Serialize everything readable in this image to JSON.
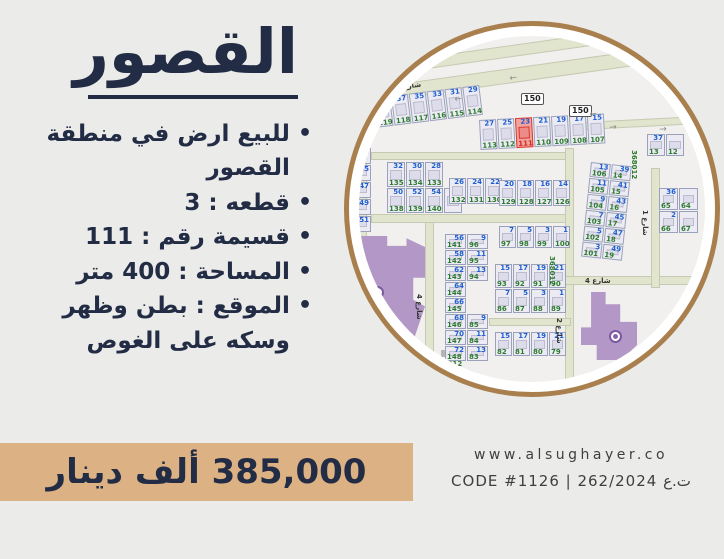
{
  "left_panel": {
    "title": "القصور",
    "bullets": [
      "للبيع ارض في منطقة القصور",
      "قطعه : 3",
      "قسيمة رقم : 111",
      "المساحة : 400 متر",
      "الموقع : بطن وظهر وسكه على الغوص"
    ]
  },
  "price_banner": {
    "text": "385,000 ألف دينار",
    "bg": "#dcb183"
  },
  "footer": {
    "website": "www.alsughayer.co",
    "code_line": "CODE #1126  |  262/2024 ت.ع"
  },
  "colors": {
    "accent_navy": "#232c45",
    "banner_tan": "#dcb183",
    "circle_border": "#a87f4d",
    "highlight_red": "#d8392d",
    "parcel_blue": "#1d5fd2",
    "parcel_green": "#2c7a2f",
    "building_purple": "#b297c7",
    "road_green": "#e2e5cd"
  },
  "map": {
    "roads": [
      {
        "x": -40,
        "y": -58,
        "w": 450,
        "h": 78,
        "rot": -8,
        "color": "#fbfbf8",
        "border": "none"
      },
      {
        "x": -25,
        "y": 34,
        "w": 400,
        "h": 12,
        "rot": -8
      },
      {
        "x": -25,
        "y": 57,
        "w": 420,
        "h": 15,
        "rot": -8
      },
      {
        "x": 225,
        "y": 86,
        "w": 130,
        "h": 8,
        "rot": -3
      },
      {
        "x": 12,
        "y": 116,
        "w": 200,
        "h": 8
      },
      {
        "x": 0,
        "y": 116,
        "w": 8,
        "h": 112
      },
      {
        "x": 12,
        "y": 178,
        "w": 200,
        "h": 9
      },
      {
        "x": 66,
        "y": 186,
        "w": 9,
        "h": 160
      },
      {
        "x": 206,
        "y": 112,
        "w": 9,
        "h": 234
      },
      {
        "x": 206,
        "y": 240,
        "w": 140,
        "h": 9
      },
      {
        "x": 292,
        "y": 132,
        "w": 9,
        "h": 120
      },
      {
        "x": 130,
        "y": 282,
        "w": 82,
        "h": 8
      }
    ],
    "street_labels": [
      {
        "text": "شارع مكراد",
        "x": 8,
        "y": 26,
        "rot": -8
      },
      {
        "text": "شارع مكراد المكر",
        "x": 2,
        "y": 53,
        "rot": -8
      },
      {
        "text": "شارع 4",
        "x": 0,
        "y": 128,
        "rot": 90
      },
      {
        "text": "شارع 4",
        "x": 64,
        "y": 258,
        "rot": 90
      },
      {
        "text": "شارع 2",
        "x": 204,
        "y": 282,
        "rot": 90
      },
      {
        "text": "شارع 1",
        "x": 290,
        "y": 174,
        "rot": 90
      },
      {
        "text": "شارع 4",
        "x": 226,
        "y": 241,
        "rot": 0
      }
    ],
    "route_badges": [
      {
        "text": "150",
        "x": 162,
        "y": 57
      },
      {
        "text": "150",
        "x": 210,
        "y": 69
      }
    ],
    "plot_codes": [
      {
        "text": "368012",
        "x": 197,
        "y": 220,
        "rot": 90
      },
      {
        "text": "368012",
        "x": 279,
        "y": 114,
        "rot": 90
      },
      {
        "text": "368012",
        "x": 74,
        "y": 324,
        "rot": 0
      }
    ],
    "arrows": [
      {
        "glyph": "←",
        "x": 55,
        "y": 28,
        "rot": -8
      },
      {
        "glyph": "←",
        "x": 150,
        "y": 39,
        "rot": -8
      },
      {
        "glyph": "←",
        "x": 95,
        "y": 60,
        "rot": -8
      },
      {
        "glyph": "←",
        "x": 230,
        "y": 75,
        "rot": -8
      },
      {
        "glyph": "→",
        "x": 250,
        "y": 88,
        "rot": -3
      },
      {
        "glyph": "→",
        "x": 300,
        "y": 90,
        "rot": -3
      }
    ],
    "blocks": [
      {
        "x": 14,
        "y": 62,
        "rot": -7,
        "cw": 17,
        "ch": 30,
        "rows": [
          [
            {
              "b": "39",
              "g": "119"
            },
            {
              "b": "37",
              "g": "118"
            },
            {
              "b": "35",
              "g": "117"
            },
            {
              "b": "33",
              "g": "116"
            },
            {
              "b": "31",
              "g": "115"
            },
            {
              "b": "29",
              "g": "114"
            }
          ]
        ]
      },
      {
        "x": 120,
        "y": 84,
        "rot": -3,
        "cw": 17,
        "ch": 30,
        "rows": [
          [
            {
              "b": "27",
              "g": "113"
            },
            {
              "b": "25",
              "g": "112"
            },
            {
              "b": "23",
              "g": "111",
              "red": true
            },
            {
              "b": "21",
              "g": "110"
            },
            {
              "b": "19",
              "g": "109"
            },
            {
              "b": "17",
              "g": "108"
            },
            {
              "b": "15",
              "g": "107"
            }
          ]
        ]
      },
      {
        "x": 288,
        "y": 98,
        "rot": 0,
        "cw": 18,
        "ch": 22,
        "rows": [
          [
            {
              "b": "37",
              "g": "13"
            },
            {
              "b": "",
              "g": "12"
            }
          ]
        ]
      },
      {
        "x": -10,
        "y": 112,
        "rot": 0,
        "cw": 22,
        "ch": 16,
        "rows": [
          [
            {
              "b": "43",
              "g": ""
            }
          ],
          [
            {
              "b": "45",
              "g": ""
            }
          ],
          [
            {
              "b": "47",
              "g": ""
            }
          ],
          [
            {
              "b": "49",
              "g": ""
            }
          ],
          [
            {
              "b": "51",
              "g": ""
            }
          ]
        ]
      },
      {
        "x": 28,
        "y": 126,
        "rot": 0,
        "cw": 18,
        "ch": 25,
        "rows": [
          [
            {
              "b": "32",
              "g": "135"
            },
            {
              "b": "30",
              "g": "134"
            },
            {
              "b": "28",
              "g": "133"
            }
          ],
          [
            {
              "b": "50",
              "g": "138"
            },
            {
              "b": "52",
              "g": "139"
            },
            {
              "b": "54",
              "g": "140"
            },
            {
              "b": "56",
              "g": ""
            }
          ]
        ]
      },
      {
        "x": 90,
        "y": 142,
        "rot": 0,
        "cw": 17,
        "ch": 26,
        "rows": [
          [
            {
              "b": "26",
              "g": "132"
            },
            {
              "b": "24",
              "g": "131"
            },
            {
              "b": "22",
              "g": "130"
            }
          ]
        ]
      },
      {
        "x": 140,
        "y": 144,
        "rot": 0,
        "cw": 17,
        "ch": 26,
        "rows": [
          [
            {
              "b": "20",
              "g": "129"
            },
            {
              "b": "18",
              "g": "128"
            },
            {
              "b": "16",
              "g": "127"
            },
            {
              "b": "14",
              "g": "126"
            }
          ]
        ]
      },
      {
        "x": 140,
        "y": 190,
        "rot": 0,
        "cw": 17,
        "ch": 22,
        "rows": [
          [
            {
              "b": "7",
              "g": "97"
            },
            {
              "b": "5",
              "g": "98"
            },
            {
              "b": "3",
              "g": "99"
            },
            {
              "b": "1",
              "g": "100"
            }
          ]
        ]
      },
      {
        "x": 136,
        "y": 228,
        "rot": 0,
        "cw": 17,
        "ch": 24,
        "rows": [
          [
            {
              "b": "15",
              "g": "93"
            },
            {
              "b": "17",
              "g": "92"
            },
            {
              "b": "19",
              "g": "91"
            },
            {
              "b": "21",
              "g": "90"
            }
          ],
          [
            {
              "b": "7",
              "g": "86"
            },
            {
              "b": "5",
              "g": "87"
            },
            {
              "b": "3",
              "g": "88"
            },
            {
              "b": "1",
              "g": "89"
            }
          ]
        ]
      },
      {
        "x": 232,
        "y": 126,
        "rot": 6,
        "cw": 20,
        "ch": 15,
        "rows": [
          [
            {
              "b": "13",
              "g": "106"
            },
            {
              "b": "39",
              "g": "14"
            }
          ],
          [
            {
              "b": "11",
              "g": "105"
            },
            {
              "b": "41",
              "g": "15"
            }
          ],
          [
            {
              "b": "9",
              "g": "104"
            },
            {
              "b": "43",
              "g": "16"
            }
          ],
          [
            {
              "b": "7",
              "g": "103"
            },
            {
              "b": "45",
              "g": "17"
            }
          ],
          [
            {
              "b": "5",
              "g": "102"
            },
            {
              "b": "47",
              "g": "18"
            }
          ],
          [
            {
              "b": "3",
              "g": "101"
            },
            {
              "b": "49",
              "g": "19"
            }
          ]
        ]
      },
      {
        "x": 86,
        "y": 198,
        "rot": 0,
        "cw": 21,
        "ch": 15,
        "rows": [
          [
            {
              "b": "56",
              "g": "141"
            },
            {
              "b": "9",
              "g": "96"
            }
          ],
          [
            {
              "b": "58",
              "g": "142"
            },
            {
              "b": "11",
              "g": "95"
            }
          ],
          [
            {
              "b": "62",
              "g": "143"
            },
            {
              "b": "13",
              "g": "94"
            }
          ],
          [
            {
              "b": "64",
              "g": "144"
            }
          ],
          [
            {
              "b": "66",
              "g": "145"
            }
          ],
          [
            {
              "b": "68",
              "g": "146"
            },
            {
              "b": "9",
              "g": "85"
            }
          ],
          [
            {
              "b": "70",
              "g": "147"
            },
            {
              "b": "11",
              "g": "84"
            }
          ],
          [
            {
              "b": "72",
              "g": "148"
            },
            {
              "b": "13",
              "g": "83"
            }
          ]
        ]
      },
      {
        "x": 136,
        "y": 296,
        "rot": 0,
        "cw": 17,
        "ch": 24,
        "rows": [
          [
            {
              "b": "15",
              "g": "82"
            },
            {
              "b": "17",
              "g": "81"
            },
            {
              "b": "19",
              "g": "80"
            },
            {
              "b": "21",
              "g": "79"
            }
          ]
        ]
      },
      {
        "x": 300,
        "y": 152,
        "rot": 0,
        "cw": 19,
        "ch": 22,
        "rows": [
          [
            {
              "b": "36",
              "g": "65"
            },
            {
              "b": "",
              "g": "64"
            }
          ],
          [
            {
              "b": "2",
              "g": "66"
            },
            {
              "b": "",
              "g": "67"
            }
          ]
        ]
      }
    ],
    "buildings": [
      {
        "x": -18,
        "y": 200,
        "w": 84,
        "h": 110,
        "shape": "poly1",
        "color": "#b297c7",
        "icon": {
          "x": 30,
          "y": 50
        }
      },
      {
        "x": 222,
        "y": 256,
        "w": 56,
        "h": 68,
        "shape": "poly2",
        "color": "#b297c7",
        "icon": {
          "x": 28,
          "y": 38
        }
      },
      {
        "x": 82,
        "y": 314,
        "w": 14,
        "h": 7,
        "shape": "rect",
        "color": "#b5b5b5"
      }
    ]
  }
}
